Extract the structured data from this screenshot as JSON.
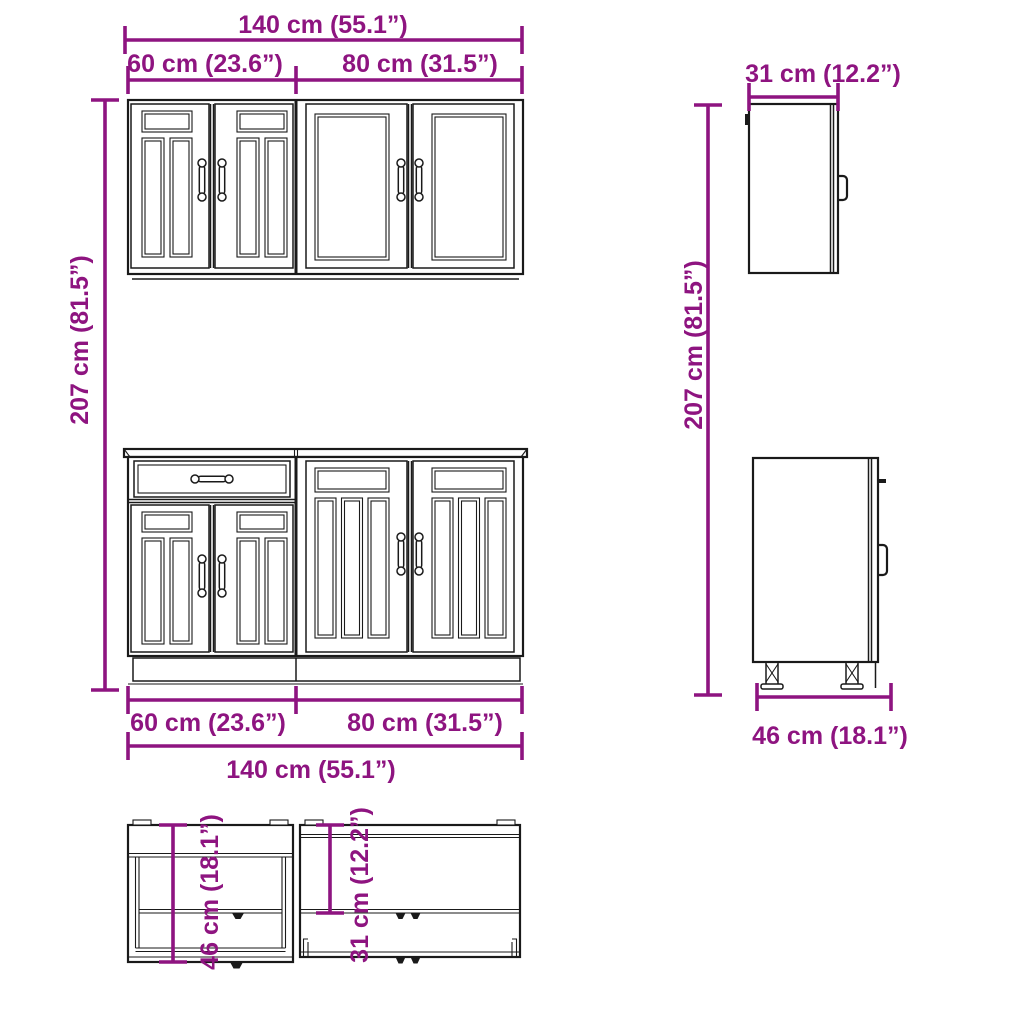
{
  "accent_color": "#8E1480",
  "line_color": "#1a1a1a",
  "dims": {
    "front_width_total": "140 cm (55.1”)",
    "front_width_left": "60 cm (23.6”)",
    "front_width_right": "80 cm (31.5”)",
    "front_height": "207 cm (81.5”)",
    "bottom_width_left": "60 cm (23.6”)",
    "bottom_width_right": "80 cm (31.5”)",
    "bottom_width_total": "140 cm (55.1”)",
    "wall_cabinet_depth": "31 cm (12.2”)",
    "side_height": "207 cm (81.5”)",
    "base_cabinet_depth": "46 cm (18.1”)",
    "top_view_base_depth": "46 cm (18.1”)",
    "top_view_wall_depth": "31 cm (12.2”)"
  }
}
